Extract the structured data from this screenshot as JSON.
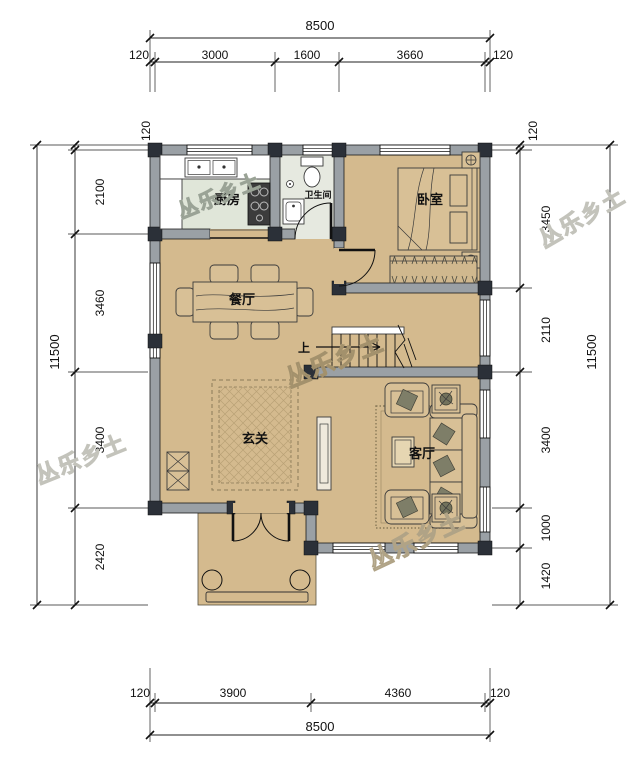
{
  "title": "两层农村自建房一层平面图",
  "watermark": {
    "text": "丛乐乡土"
  },
  "rooms": {
    "kitchen": "厨房",
    "bathroom": "卫生间",
    "bedroom": "卧室",
    "dining": "餐厅",
    "foyer": "玄关",
    "living": "客厅"
  },
  "stairs": {
    "up_label": "上"
  },
  "dims": {
    "top": {
      "total": "8500",
      "segments": [
        "120",
        "3000",
        "1600",
        "3660",
        "120"
      ]
    },
    "bottom": {
      "total": "8500",
      "segments": [
        "120",
        "3900",
        "4360",
        "120"
      ]
    },
    "left": {
      "total": "11500",
      "segments": [
        "120",
        "2100",
        "3460",
        "3400",
        "2420"
      ]
    },
    "right": {
      "total": "11500",
      "segments": [
        "120",
        "3450",
        "2110",
        "3400",
        "1000",
        "1420"
      ]
    }
  },
  "colors": {
    "floor_main": "#d4ba8e",
    "floor_kitchen": "#e0e6d9",
    "floor_bath": "#e6e9e0",
    "wall": "#9aa0a5",
    "column": "#2b3038",
    "rug_lattice": "#b9a176"
  }
}
